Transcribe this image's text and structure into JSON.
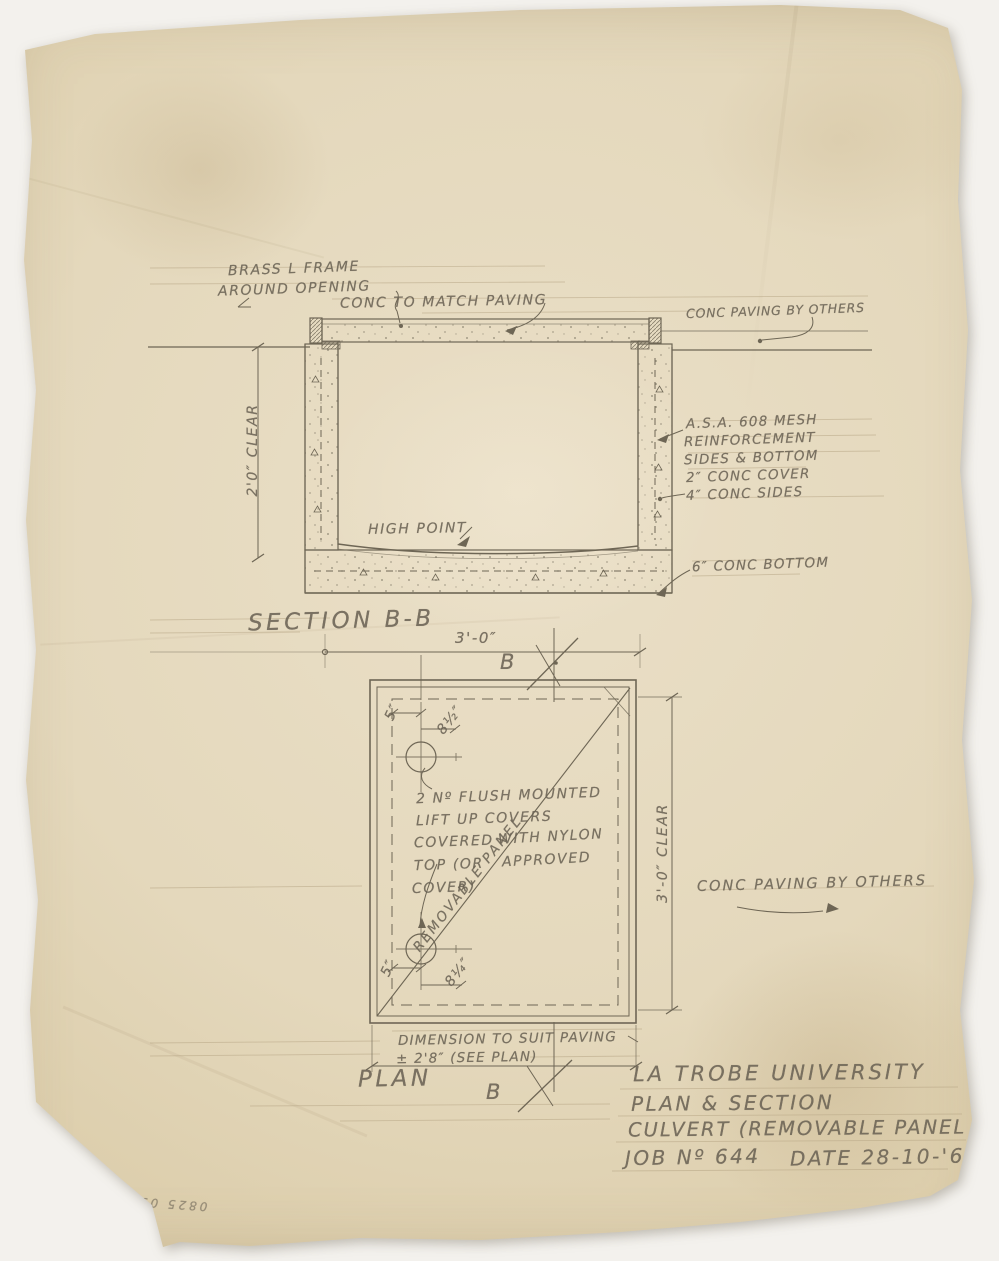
{
  "section": {
    "title": "SECTION B-B",
    "marker_top": "B",
    "marker_bottom": "B",
    "notes": {
      "brass1": "BRASS L FRAME",
      "brass2": "AROUND OPENING",
      "conc_match": "CONC TO MATCH PAVING",
      "paving_others": "CONC PAVING BY OTHERS",
      "mesh1": "A.S.A. 608 MESH",
      "mesh2": "REINFORCEMENT",
      "mesh3": "SIDES & BOTTOM",
      "mesh4": "2″ CONC COVER",
      "sides": "4″ CONC SIDES",
      "high_point": "HIGH POINT",
      "bottom": "6″ CONC BOTTOM"
    },
    "dims": {
      "clear": "2'0″ CLEAR",
      "width": "3'-0″"
    }
  },
  "plan": {
    "title": "PLAN",
    "dims": {
      "top_offset": "5″",
      "top_diag": "8½″",
      "bottom_offset": "5″",
      "bottom_diag": "8¼″",
      "clear": "3'-0″ CLEAR"
    },
    "notes": {
      "covers1": "2 Nº FLUSH MOUNTED",
      "covers2": "LIFT UP COVERS",
      "covers3": "COVERED",
      "covers4": "TOP (OR",
      "covers5": "COVER)",
      "covers6": "WITH NYLON",
      "covers7": "APPROVED",
      "removable": "REMOVABLE PANEL",
      "paving_others": "CONC PAVING BY OTHERS",
      "dim_note1": "DIMENSION TO SUIT PAVING",
      "dim_note2": "± 2'8″ (SEE PLAN)"
    }
  },
  "title_block": {
    "line1": "LA TROBE UNIVERSITY",
    "line2": "PLAN & SECTION",
    "line3": "CULVERT (REMOVABLE PANEL",
    "job": "JOB Nº 644",
    "date": "DATE 28-10-'66"
  },
  "margin_note": "0825 05280"
}
